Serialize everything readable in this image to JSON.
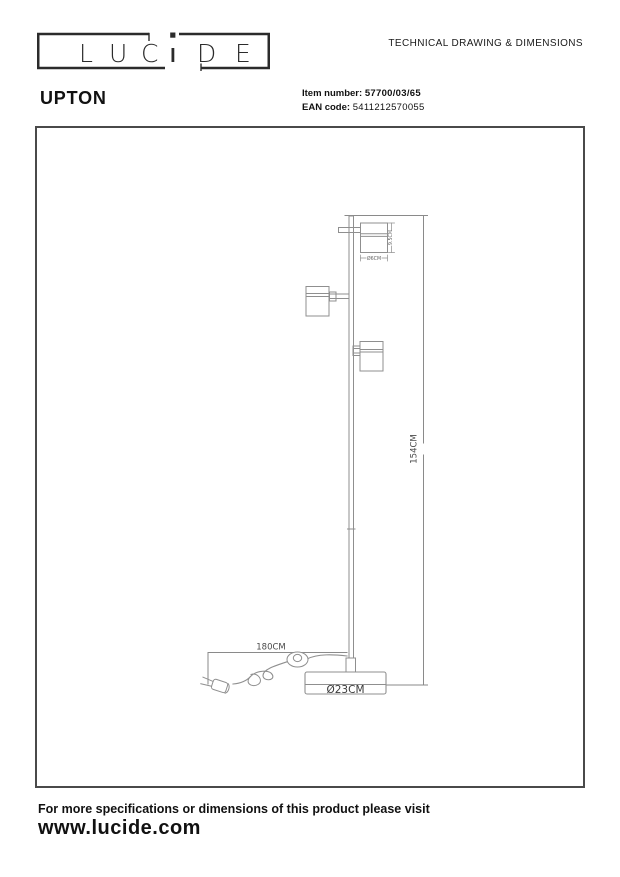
{
  "header": {
    "logo": {
      "text": "LUCIDE",
      "letters": [
        "L",
        "U",
        "C",
        "i",
        "D",
        "E"
      ]
    },
    "doc_title": "TECHNICAL DRAWING & DIMENSIONS",
    "product_name": "UPTON",
    "item_number_label": "Item number:",
    "item_number_value": "57700/03/65",
    "ean_label": "EAN code:",
    "ean_value": "5411212570055"
  },
  "drawing": {
    "dimensions": {
      "height": "154CM",
      "cable_length": "180CM",
      "base_diameter": "Ø23CM",
      "head_diameter": "Ø6CM",
      "head_height": "9.5CM"
    }
  },
  "footer": {
    "line1": "For more specifications or dimensions of this product please visit",
    "line2": "www.lucide.com"
  },
  "colors": {
    "line": "#8f8f8f",
    "dim_text": "#555555",
    "frame": "#4a4a4a",
    "text": "#111111"
  }
}
